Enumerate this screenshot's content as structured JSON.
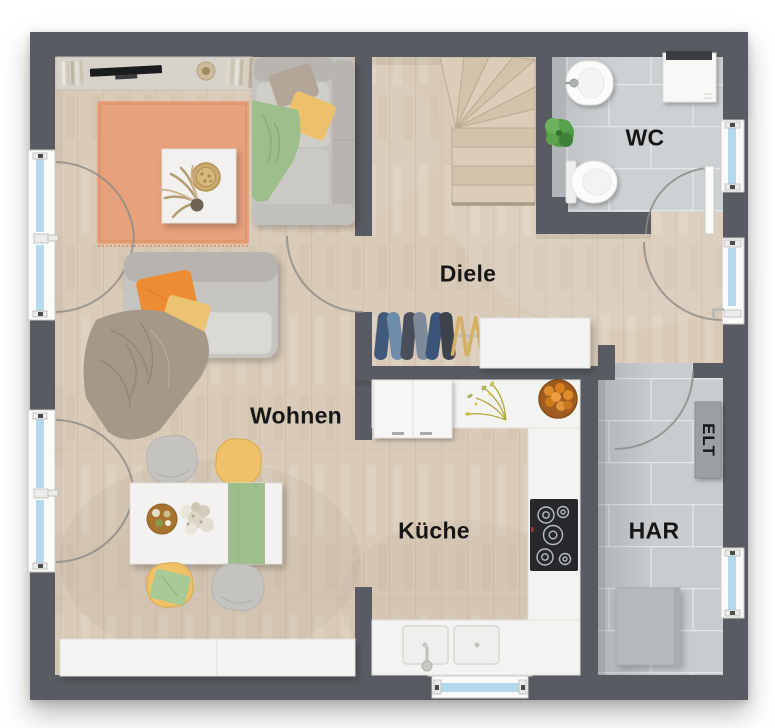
{
  "rooms": {
    "wohnen": {
      "label": "Wohnen"
    },
    "diele": {
      "label": "Diele"
    },
    "wc": {
      "label": "WC"
    },
    "kueche": {
      "label": "Küche"
    },
    "har": {
      "label": "HAR"
    },
    "elt": {
      "label": "ELT"
    }
  },
  "colors": {
    "wall": "#585b61",
    "floor_wood": "#dacbb9",
    "tile": "#ced1d3",
    "rug": "#e7a17c",
    "accent_orange": "#ed8c31",
    "accent_yellow": "#ecc06d",
    "accent_green": "#9dbf8b",
    "window_glass": "#b5d9ec",
    "furniture_white": "#f3f3f1",
    "label_text": "#161616"
  }
}
